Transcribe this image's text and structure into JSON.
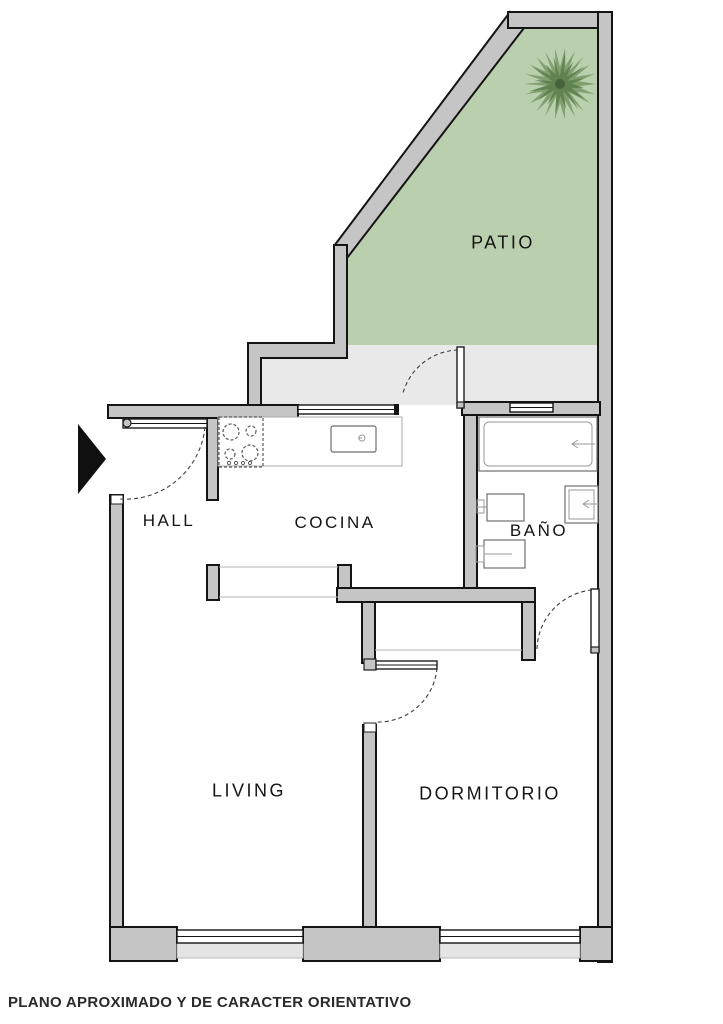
{
  "plan": {
    "rooms": [
      {
        "id": "patio",
        "label": "PATIO"
      },
      {
        "id": "hall",
        "label": "HALL"
      },
      {
        "id": "cocina",
        "label": "COCINA"
      },
      {
        "id": "bano",
        "label": "BAÑO"
      },
      {
        "id": "living",
        "label": "LIVING"
      },
      {
        "id": "dormitorio",
        "label": "DORMITORIO"
      }
    ],
    "footer": {
      "disclaimer": "PLANO APROXIMADO Y DE CARACTER ORIENTATIVO"
    },
    "colors": {
      "patio_green": "#b9cfad",
      "terrace_gray": "#e9e9e9",
      "wall_gray": "#c5c5c5",
      "outline": "#141414",
      "palm_green": "#7d9c6c"
    }
  }
}
